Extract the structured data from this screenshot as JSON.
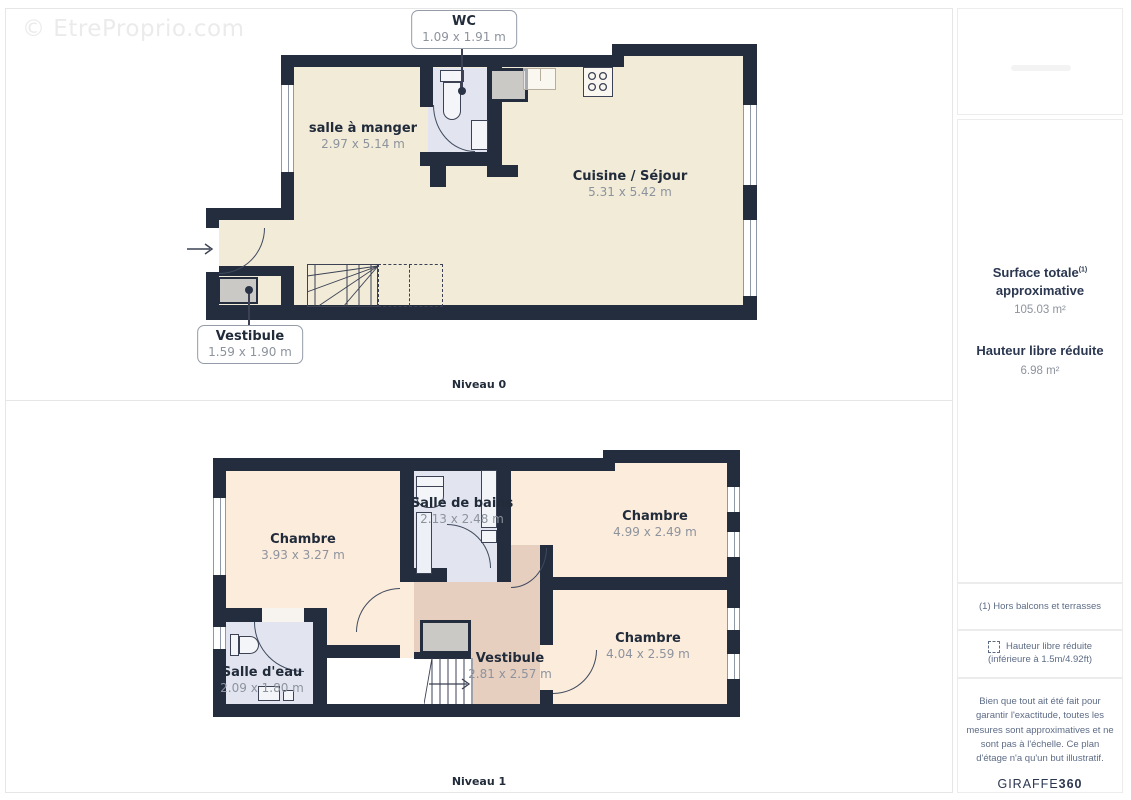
{
  "watermark": "© EtreProprio.com",
  "plans": {
    "level0": {
      "label": "Niveau 0",
      "callouts": {
        "wc": {
          "name": "WC",
          "dims": "1.09 x 1.91 m"
        },
        "vestibule": {
          "name": "Vestibule",
          "dims": "1.59 x 1.90 m"
        }
      },
      "rooms": {
        "salle_a_manger": {
          "name": "salle à manger",
          "dims": "2.97 x 5.14 m"
        },
        "cuisine_sejour": {
          "name": "Cuisine / Séjour",
          "dims": "5.31 x 5.42 m"
        }
      }
    },
    "level1": {
      "label": "Niveau 1",
      "rooms": {
        "chambre_nw": {
          "name": "Chambre",
          "dims": "3.93 x 3.27 m"
        },
        "salle_de_bains": {
          "name": "Salle de bains",
          "dims": "2.13 x 2.48 m"
        },
        "chambre_ne": {
          "name": "Chambre",
          "dims": "4.99 x 2.49 m"
        },
        "chambre_se": {
          "name": "Chambre",
          "dims": "4.04 x 2.59 m"
        },
        "salle_deau": {
          "name": "Salle d'eau",
          "dims": "2.09 x 1.80 m"
        },
        "vestibule": {
          "name": "Vestibule",
          "dims": "2.81 x 2.57 m"
        }
      }
    }
  },
  "sidebar": {
    "surface_title_line1": "Surface totale",
    "surface_title_sup": "(1)",
    "surface_title_line2": "approximative",
    "surface_value": "105.03 m²",
    "hauteur_title": "Hauteur libre réduite",
    "hauteur_value": "6.98 m²",
    "footnote": "(1) Hors balcons et terrasses",
    "legend_line1": "Hauteur libre réduite",
    "legend_line2": "(inférieure à 1.5m/4.92ft)",
    "disclaimer": "Bien que tout ait été fait pour garantir l'exactitude, toutes les mesures sont approximatives et ne sont pas à l'échelle. Ce plan d'étage n'a qu'un but illustratif.",
    "brand_name": "GIRAFFE",
    "brand_suffix": "360"
  },
  "colors": {
    "wall": "#232d3d",
    "floor0": "#f1ebd8",
    "floor1": "#fcecdc",
    "wet": "#e2e5ef",
    "vest": "#e7cfc0",
    "closet": "#cac9c5",
    "ink": "#212b3a",
    "dim": "#8d939d",
    "line": "#e6e6e6",
    "muted": "#5d6c86",
    "navy": "#2b3750"
  }
}
